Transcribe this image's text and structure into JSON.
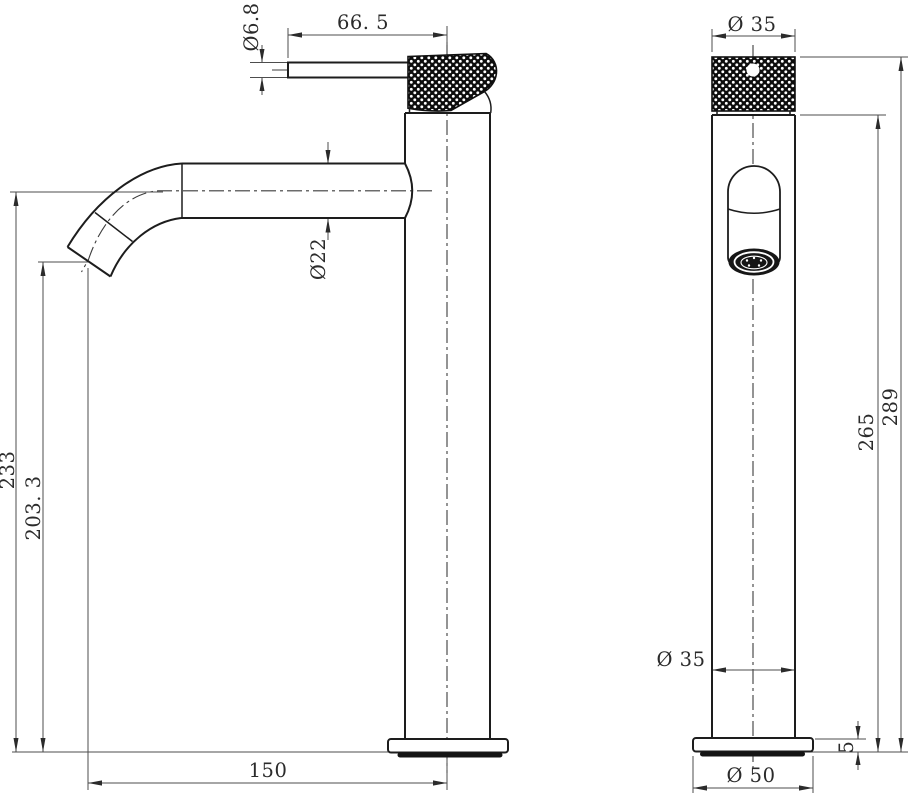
{
  "drawing": {
    "colors": {
      "background": "#ffffff",
      "outline": "#1d1d1d",
      "dimension_lines": "#4d4d4d",
      "text": "#2b2b2b",
      "knurl": "#0d0d0d"
    },
    "dimensions": {
      "side_view": {
        "handle_diameter": "Ø6.8",
        "handle_length": "66. 5",
        "spout_diameter": "Ø22",
        "height_to_spout_centerline": "233",
        "height_to_spout_tip": "203. 3",
        "spout_reach": "150"
      },
      "front_view": {
        "cap_diameter": "Ø 35",
        "total_height": "289",
        "body_height": "265",
        "body_diameter": "Ø 35",
        "base_thickness": "5",
        "base_diameter": "Ø 50"
      }
    }
  }
}
